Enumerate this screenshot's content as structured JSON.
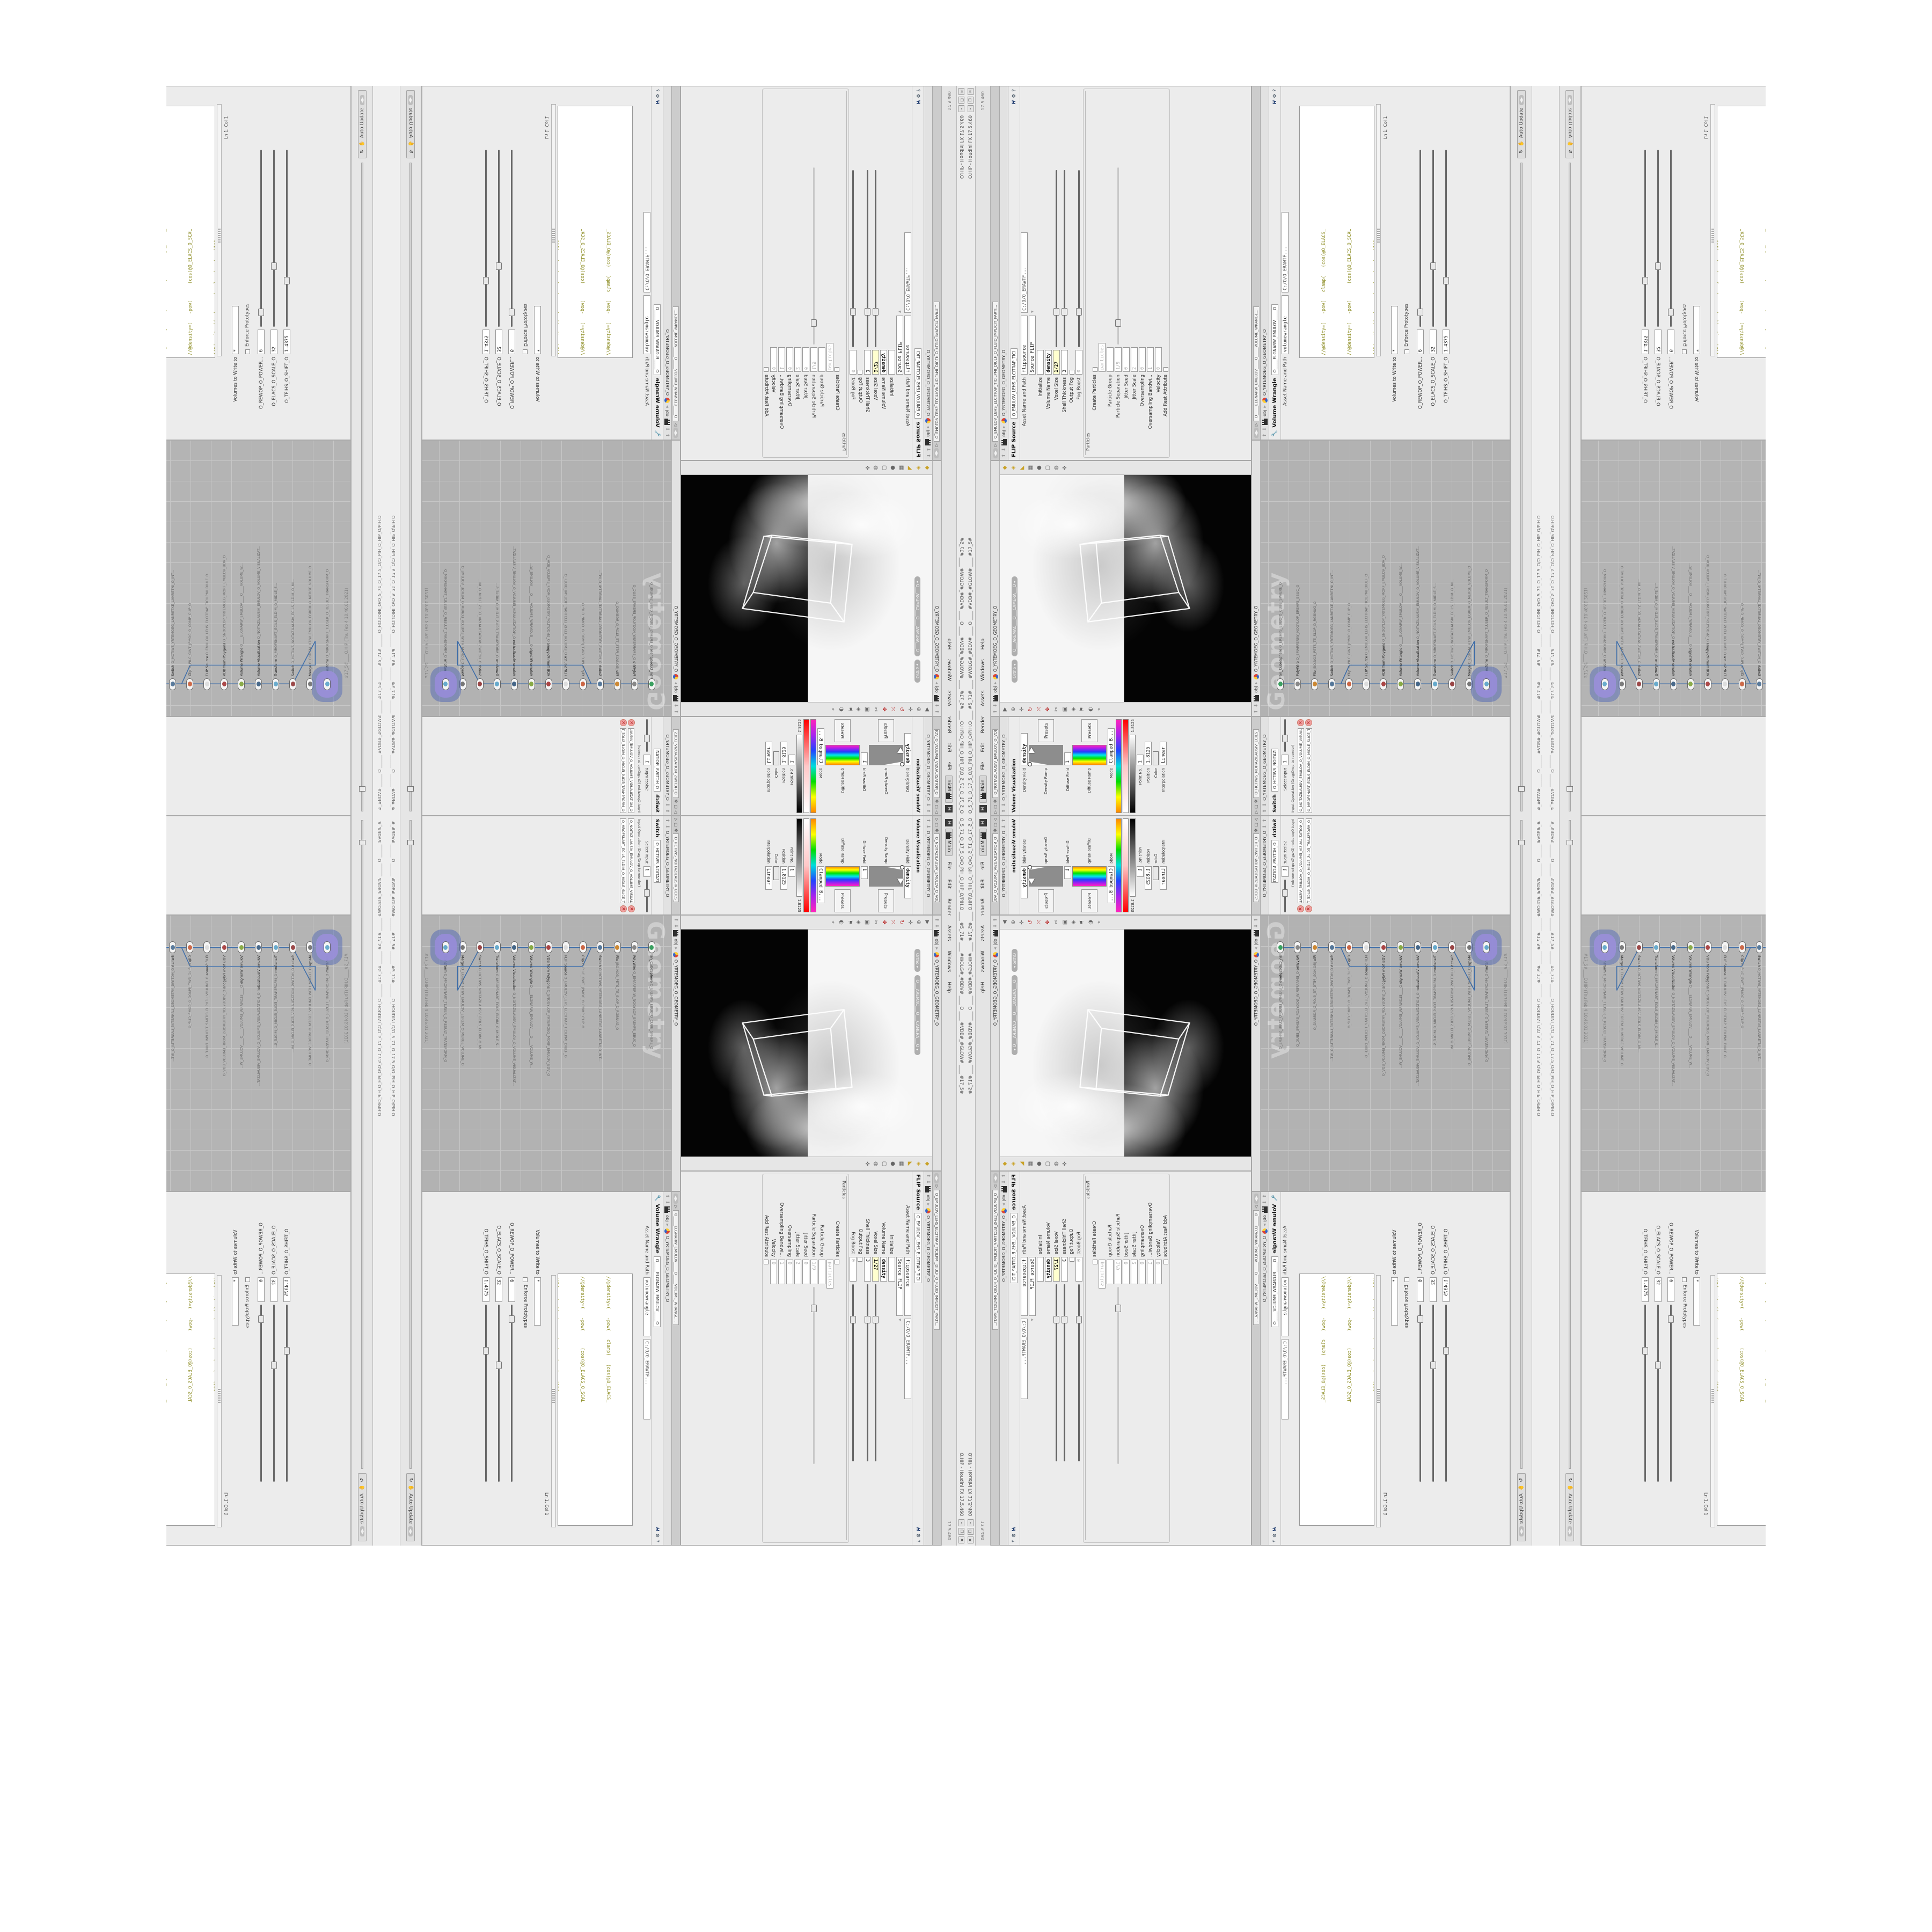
{
  "window": {
    "title_left": "O_5_71_O_17_5_O/O_PIH_O_HIP_O/PIH.O ____ #5_71# ____ #WOLG#_#BDV# ____ O ____ #VDB#_#GLOW# ____ #17_5#",
    "title_right": "O.HIP - Houdini FX 17.5.460",
    "buttons": [
      {
        "g": "–"
      },
      {
        "g": "❐"
      },
      {
        "g": "✕"
      }
    ]
  },
  "menubar": {
    "home_glyph": "H",
    "desktop": "Main",
    "items": [
      {
        "label": "File"
      },
      {
        "label": "Edit"
      },
      {
        "label": "Render"
      },
      {
        "label": "Assets"
      },
      {
        "label": "Windows"
      },
      {
        "label": "Help"
      }
    ],
    "version": "17.5.460"
  },
  "viz": {
    "tab": "O_NOITAZILAUSIV_EMULOV_O_VOLUME_VISUALIZAT...",
    "path": "O_YRTEMOEG_O_GEOMETRY_O",
    "header": "Volume Visualization",
    "header_tab": "O_NOITAZILAUSIV_EMULOV_O",
    "density_field_label": "Density Field",
    "density_field_value": "density",
    "density_ramp_label": "Density Ramp",
    "presets_label": "Presets",
    "diffuse_field_label": "Diffuse Field",
    "diffuse_field_value": "1",
    "diffuse_ramp_label": "Diffuse Ramp",
    "mode_label": "Mode",
    "mode_value": "Clamped B...",
    "ramp_value": "1.8125",
    "point_label": "Point No.",
    "point_value": "1",
    "position_label": "Position",
    "position_value": "1.8125",
    "color_label": "Color",
    "interp_label": "Interpolation",
    "interp_value": "Linear"
  },
  "viewport": {
    "path": "O_YRTEMOEG_O_GEOMETRY_O",
    "crumb_root": "obj",
    "ortho_pill": "Ortho ▾",
    "camera_pill": "O___AREMAC___O___CAMERA___O ▾",
    "left_icons": [
      {
        "g": "▶"
      },
      {
        "g": "⊕"
      },
      {
        "g": "✛"
      },
      {
        "g": "↻",
        "c": "red"
      },
      {
        "g": "⤧",
        "c": "red"
      },
      {
        "g": "✥",
        "c": "red"
      },
      {
        "g": "✂"
      },
      {
        "g": "▣"
      },
      {
        "g": "◈"
      },
      {
        "g": "⚑"
      },
      {
        "g": "◐"
      },
      {
        "g": "⌖"
      }
    ],
    "right_icons": [
      {
        "g": "◆",
        "c": "yel"
      },
      {
        "g": "◈",
        "c": "yel"
      },
      {
        "g": "◣",
        "c": "yel"
      },
      {
        "g": "▦"
      },
      {
        "g": "●"
      },
      {
        "g": "▢"
      },
      {
        "g": "◍"
      },
      {
        "g": "✜"
      }
    ]
  },
  "flip": {
    "tab": "O_EMULOV_LEHS_ELCITRAP_TICILPMI_DIULF_O_FLUID_IMPLICIT_PARTI...",
    "path": "O_YRTEMOEG_O_GEOMETRY_O",
    "crumb_root": "obj",
    "header": "FLIP Source",
    "header_tab": "O_EMULOV_LEHS_ELCITRAP_TICI",
    "asset_label": "Asset Name and Path",
    "asset_value": "flipsource",
    "asset_path": "C:/O/O_ERAWTF...",
    "source_label": "",
    "source_value": "Source FLIP",
    "rows": [
      {
        "label": "Initialize",
        "value": "",
        "cls": "plain"
      },
      {
        "label": "Volume Name",
        "value": "density",
        "cls": "bold"
      },
      {
        "label": "Voxel Size",
        "value": "1/27",
        "cls": "yellow slider"
      },
      {
        "label": "Shell Thickness",
        "value": "3",
        "cls": "slider"
      },
      {
        "label": "Output Fog",
        "value": "",
        "cls": "check"
      },
      {
        "label": "Fog Boost",
        "value": "0",
        "cls": "gray fslider"
      }
    ],
    "particles_section": "Particles",
    "particle_rows": [
      {
        "label": "Create Particles",
        "value": "",
        "cls": "check"
      },
      {
        "label": "",
        "value": "particles",
        "cls": "gray"
      },
      {
        "label": "Particle Group",
        "value": "",
        "cls": "gray"
      },
      {
        "label": "Particle Separation",
        "value": "1/9",
        "cls": "gray fslider"
      },
      {
        "label": "Jitter Seed",
        "value": "0",
        "cls": "gray"
      },
      {
        "label": "Jitter Scale",
        "value": "2",
        "cls": "gray"
      },
      {
        "label": "Oversampling",
        "value": "0",
        "cls": "gray"
      },
      {
        "label": "Oversampling Bandwi...",
        "value": "1",
        "cls": "gray"
      },
      {
        "label": "Velocity",
        "value": "0",
        "cls": "gray"
      },
      {
        "label": "Add Rest Attribute",
        "value": "",
        "cls": "check"
      }
    ]
  },
  "switch": {
    "tab": "O_HCTIWS_NOITAZILAUSIV_ECILS_ELDIM_O_MI...",
    "path": "O_YRTEMOEG_O_GEOMETRY_O",
    "header": "Switch",
    "header_tab": "O_HCTIWS_NOITAZILAUSIV...",
    "select_label": "Select Input",
    "select_value": "1",
    "inputop_label": "Input Operation (Drag/Drop to reorder)",
    "inputs": [
      {
        "name": "O_NOITAZILAUSIV_EMULOV_O_VOLUME_VISUALIZATION_O"
      },
      {
        "name": "O_MROFSNART_ECILS_ELDIM_O_MIDLE_SLICE_TRANSFORM_O"
      }
    ]
  },
  "network": {
    "crumb_root": "obj",
    "path": "O_YRTEMOEG_O_GEOMETRY_O",
    "watermark": "Geometry",
    "stamp": "#17_5#____O.HIP (Thu Feb 4 10:46:01 2021)",
    "nodes": [
      {
        "nm": "an_CubeSphere",
        "sub": "O_EREHPS_EBUC_O_CUBE_SPHERE_O",
        "col": "#3aa060"
      },
      {
        "nm": "PolyWire",
        "sub": "O_EMARFERIW_NOGYLOP_EREHPS_EBUC_O",
        "col": "#888888"
      },
      {
        "nm": "File",
        "sub": "JBO.NO3_PETS_TE_SLOP_D_RGBNUG_O",
        "col": "#cc8833"
      },
      {
        "nm": "Switch",
        "sub": "O_HCTIWS_YRTEMOEG_LANRETXE_LANRETNI_O_INT...",
        "col": "#557799"
      },
      {
        "nm": "Clip",
        "sub": "O_PILC_GWT_JPMOC_O_COMP_CLIP_O",
        "col": "#cc6644"
      },
      {
        "nm": "FLIP Source",
        "sub": "O_EMULOV_LEHS_ELCITRAP_TICILPMI_DIULF_O",
        "col": "#dddddd"
      },
      {
        "nm": "VDB from Polygons",
        "sub": "O_SNOGYLOP_YRTEMOEG_MORF_EMULOV_BDV_O",
        "col": "#aa4444"
      },
      {
        "nm": "Volume Wrangle",
        "sub": "O____ELGNARW_EMULOV____O____VOLUME_W...",
        "col": "#88aa44"
      },
      {
        "nm": "Volume Visualization",
        "sub": "O_NOITAZILAUSIV_EMULOV_O_VOLUME_VISUALIZAT...",
        "col": "#446688"
      },
      {
        "nm": "Transform",
        "sub": "O_MROFSNART_ECILS_ELDIM_O_MIDLE_S...",
        "col": "#66aacc"
      },
      {
        "nm": "Switch",
        "sub": "O_HCTIWS_NOITAZILAUSIV_ECILS_ELDIM_O_MI...",
        "col": "#994444"
      },
      {
        "nm": "Merge",
        "sub": "O_EGREM_HTIW_EMULOV_EGREM_O_MERGE_VOLUME_O",
        "col": "#777777"
      },
      {
        "nm": "Transform",
        "sub": "O_MROFSNART_TLUSER_O_RESULT_TRANSFORM_O",
        "col": "#66aacc",
        "cls": "selected"
      }
    ]
  },
  "wrangle": {
    "tab": "O_____ELGNARW_EMULOV_____O_____VOLUME_WRANGL...",
    "path": "O_YRTEMOEG_O_GEOMETRY_O",
    "crumb_root": "obj",
    "header": "Volume Wrangle",
    "header_tab": "O_____ELGNARW_EMULOV_____O",
    "asset_label": "Asset Name and Path",
    "asset_value": "volumewrangle",
    "asset_path": "C:/O/O_ERAWTF...",
    "code": [
      {
        "t": "//@density=(   -pow(   clamp(   (cos(@O_ELACS_"
      },
      {
        "t": "//@density=(   -pow(      (cos(@O_ELACS_O_SCAL"
      },
      {
        "t": "//@density=((  (  -pow(  clamp(   (cos(1*$"
      },
      {
        "t": "//@density=((  -pow(     (cos((clamp(@O_TFIHS"
      },
      {
        "t": "//@density=((  (  -pow(  clamp(   (cos( cl"
      },
      {
        "t": "//@density=((        (pow((      1./"
      },
      {
        "t": "//@density=((pow((     1./ (1.-clamp("
      },
      {
        "t": "@density=((        ((pow((      1./",
        "cls": "last"
      }
    ],
    "lncol": "Ln 1, Col 1",
    "volumes_label": "Volumes to Write to",
    "volumes_value": "*",
    "enforce_label": "Enforce Prototypes",
    "power_label": "O_REWOP_O_POWER...",
    "power_value": "6",
    "scale_label": "O_ELACS_O_SCALE_O",
    "scale_value": "32",
    "shift_label": "O_TFIHS_O_SHIFT_O",
    "shift_value": "1.4375"
  },
  "playbar": {
    "auto_update": "Auto Update",
    "recook_glyph": "↻",
    "flag_glyph": "✋"
  },
  "statusbar": {
    "text": "#_#BDV# ______ O ______ #VDB#_#GLOW# ______ #17_5# ______ #5_71# ______ O_HOUDINI_O/O_5_71_O_17.5_O/O_PIH_O_HIP_O/PIH.O"
  }
}
